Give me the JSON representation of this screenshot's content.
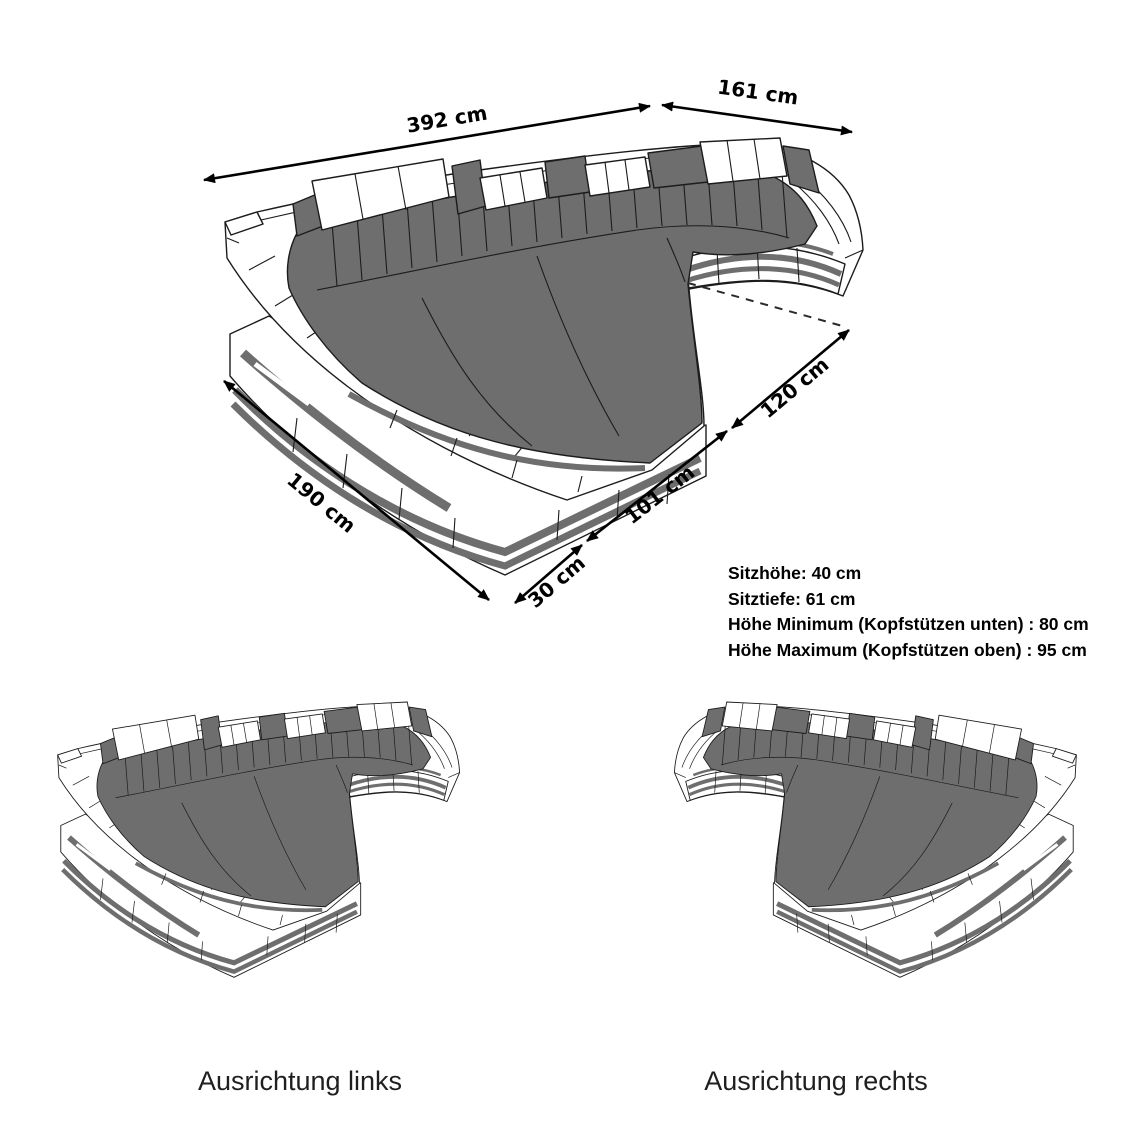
{
  "main_diagram": {
    "dimensions": {
      "total_width": "392 cm",
      "right_width": "161 cm",
      "left_depth": "190 cm",
      "corner": "30 cm",
      "front_edge": "101 cm",
      "right_depth": "120 cm"
    },
    "specs": {
      "seat_height": "Sitzhöhe: 40 cm",
      "seat_depth": "Sitztiefe: 61 cm",
      "height_min": "Höhe Minimum (Kopfstützen unten) : 80 cm",
      "height_max": "Höhe Maximum (Kopfstützen oben) : 95 cm"
    }
  },
  "variants": {
    "left": {
      "label": "Ausrichtung links"
    },
    "right": {
      "label": "Ausrichtung rechts"
    }
  },
  "colors": {
    "upholstery_dark": "#6e6e6e",
    "outline": "#1c1c1c",
    "shell_white": "#ffffff",
    "background": "#ffffff",
    "text": "#000000"
  }
}
